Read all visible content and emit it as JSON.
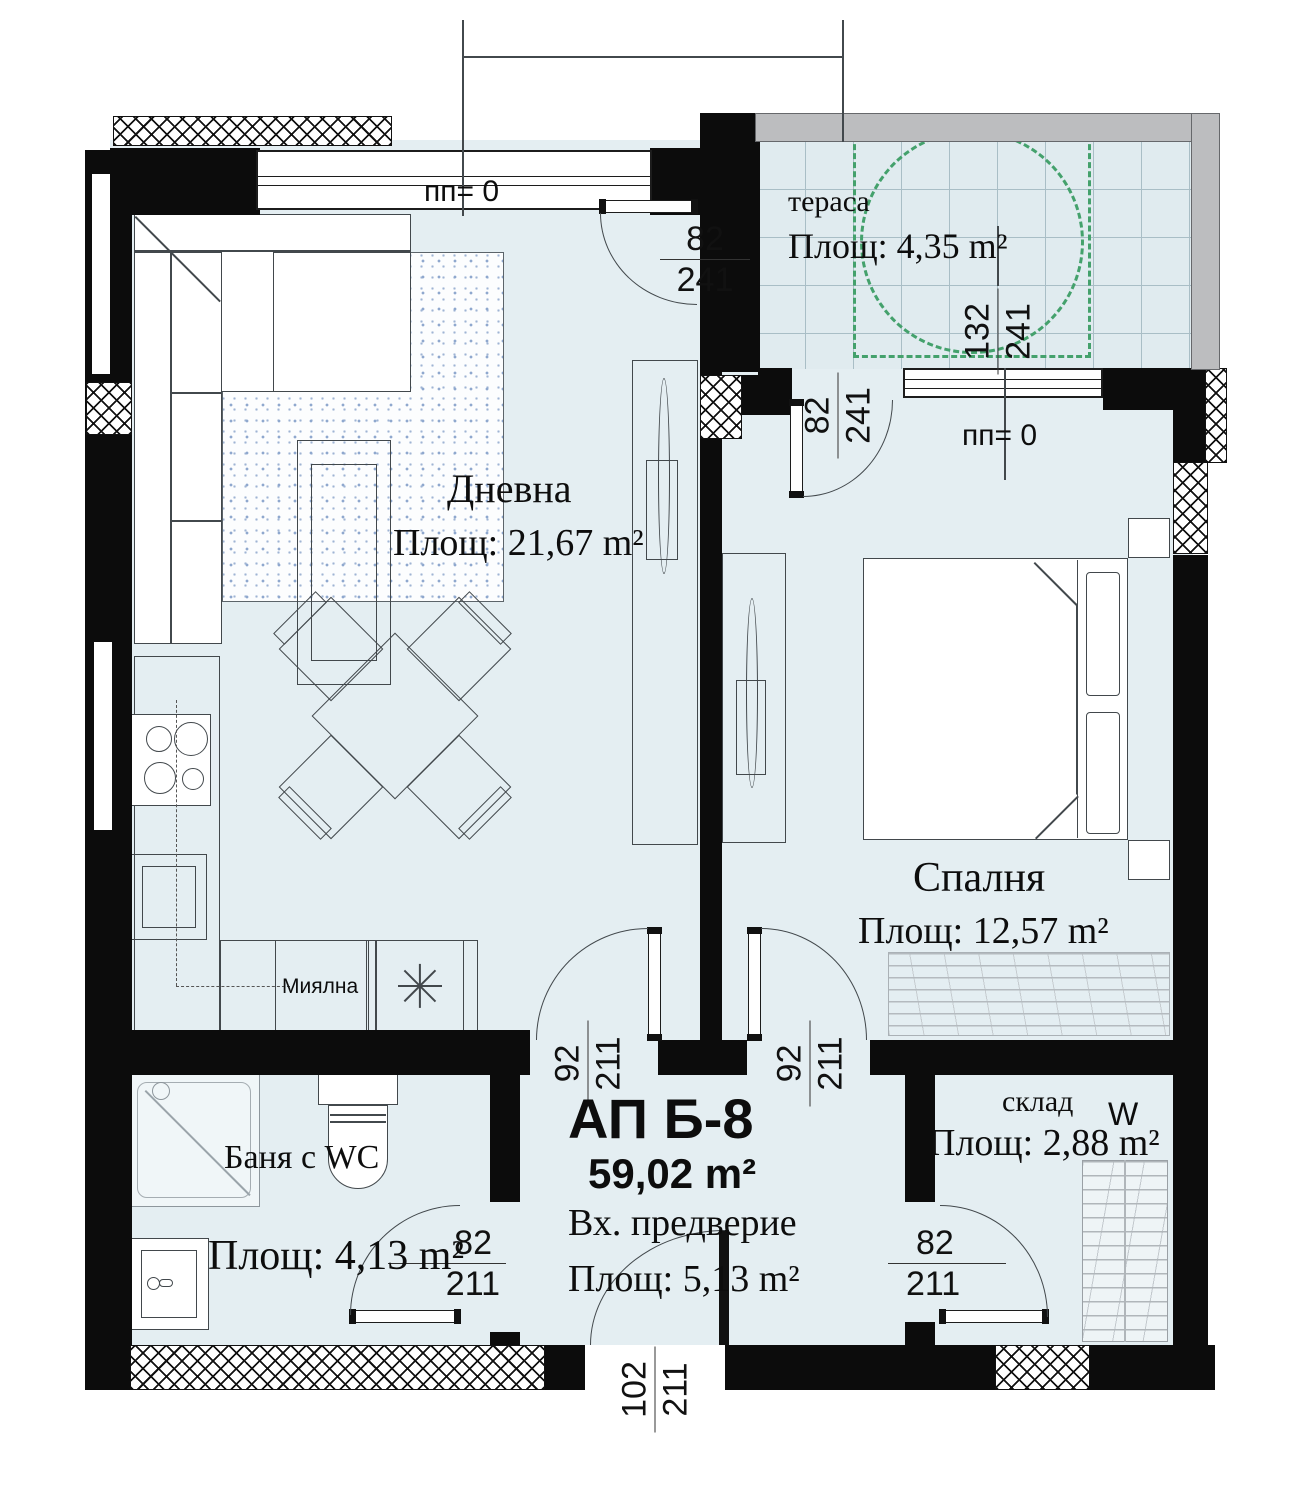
{
  "apartment": {
    "id": "АП Б-8",
    "area": "59,02 m²"
  },
  "rooms": {
    "living": {
      "name": "Дневна",
      "area": "Площ: 21,67 m²",
      "parapet": "пп= 0"
    },
    "terrace": {
      "name": "тераса",
      "area": "Площ: 4,35 m²"
    },
    "bedroom": {
      "name": "Спалня",
      "area": "Площ: 12,57 m²",
      "parapet": "пп= 0"
    },
    "bathroom": {
      "name": "Баня с WC",
      "area": "Площ: 4,13 m²"
    },
    "hallway": {
      "name": "Вх. предверие",
      "area": "Площ: 5,13 m²"
    },
    "storage": {
      "name": "склад",
      "area": "Площ: 2,88 m²",
      "wardrobe_mark": "W"
    },
    "kitchen": {
      "sink_label": "Миялна",
      "appliance_icon": "eight-spoke-star"
    }
  },
  "dimensions": {
    "living_terrace_door": {
      "w": "82",
      "h": "241"
    },
    "terrace_window": {
      "w": "132",
      "h": "241"
    },
    "bedroom_terrace_door": {
      "w": "82",
      "h": "241"
    },
    "living_hall_door": {
      "w": "92",
      "h": "211"
    },
    "bedroom_hall_door": {
      "w": "92",
      "h": "211"
    },
    "bathroom_door": {
      "w": "82",
      "h": "211"
    },
    "storage_door": {
      "w": "82",
      "h": "211"
    },
    "entrance_door": {
      "w": "102",
      "h": "211"
    }
  },
  "colors": {
    "floor": "#e4eef2",
    "wall": "#0c0c0c",
    "terrace_accent": "#44a16c",
    "outer_wall": "#bcbdbf",
    "rug_dot": "#8fa8ce"
  }
}
